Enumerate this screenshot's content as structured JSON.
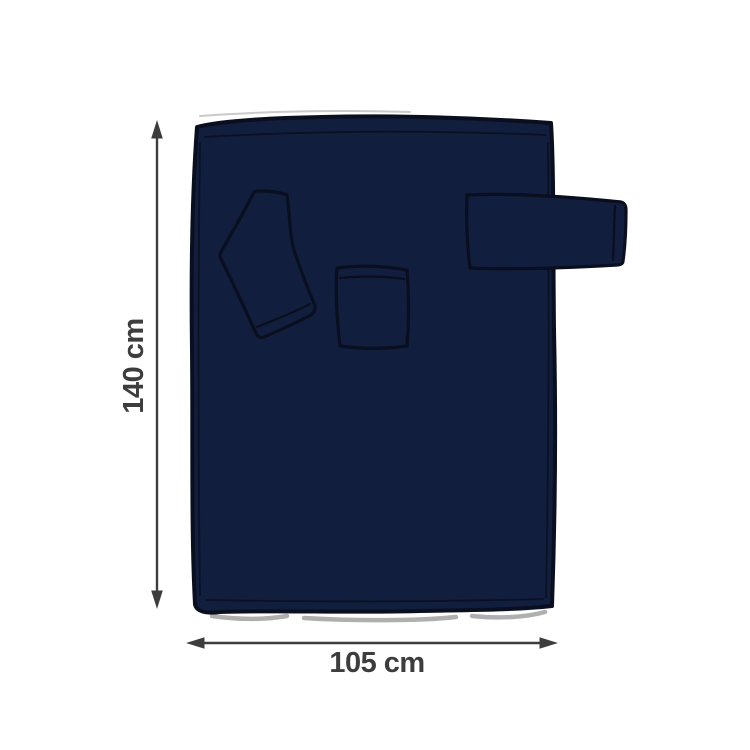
{
  "diagram": {
    "kind": "product-dimension-illustration",
    "subject": "navy wearable blanket with two sleeves and a front pocket",
    "dimensions": {
      "height": {
        "label": "140 cm",
        "value": 140,
        "unit": "cm",
        "orientation": "vertical"
      },
      "width": {
        "label": "105 cm",
        "value": 105,
        "unit": "cm",
        "orientation": "horizontal"
      }
    },
    "parts": [
      "blanket-body",
      "folded-left-sleeve",
      "front-pocket",
      "extended-right-sleeve"
    ],
    "colors": {
      "background": "#ffffff",
      "blanket_fill": "#111e3e",
      "blanket_outline": "#0a0f1f",
      "dimension": "#3d3d3e",
      "shadow": "#8d8d8d",
      "sketch": "#b4b4b4"
    }
  }
}
